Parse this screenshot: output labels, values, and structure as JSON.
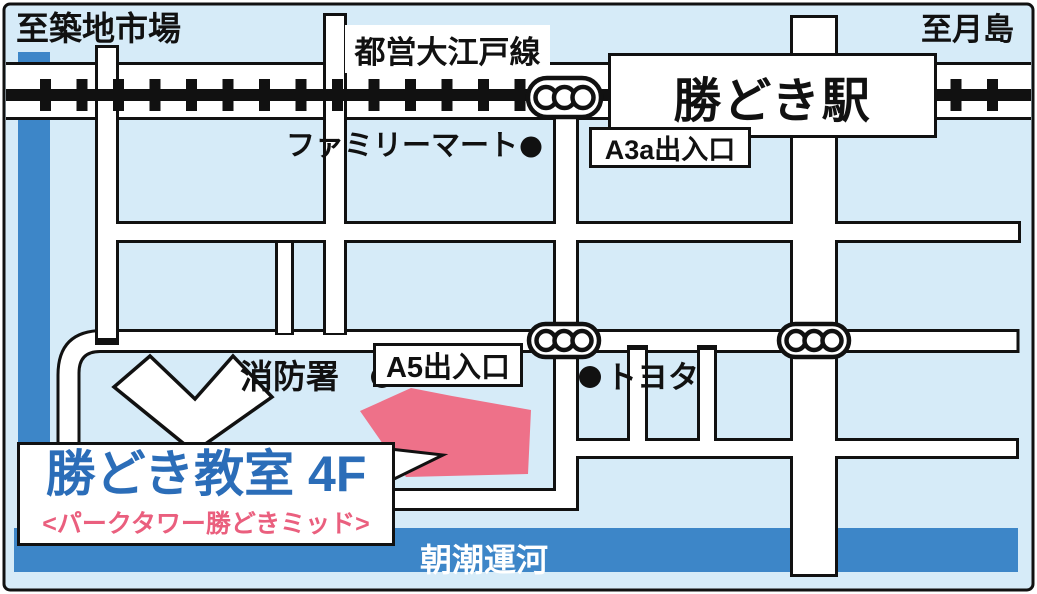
{
  "header": {
    "to_tsukiji": "至築地市場",
    "oedo_line": "都営大江戸線",
    "to_tsukishima": "至月島",
    "station": "勝どき駅"
  },
  "landmarks": {
    "familymart": "ファミリーマート",
    "a3a_exit": "A3a出入口",
    "a5_exit": "A5出入口",
    "fire_station": "消防署",
    "toyota": "トヨタ"
  },
  "destination": {
    "name": "勝どき教室 4F",
    "building": "<パークタワー勝どきミッド>"
  },
  "water": {
    "canal": "朝潮運河"
  },
  "icons": {
    "signal": "traffic-signal-icon",
    "marker": "place-dot-icon"
  },
  "colors": {
    "background": "#d6ebf8",
    "water": "#3d86c8",
    "building": "#ee7189",
    "classroom_text": "#2b6db8",
    "subtitle_text": "#ea5f7e",
    "road": "#ffffff",
    "outline": "#111111"
  }
}
